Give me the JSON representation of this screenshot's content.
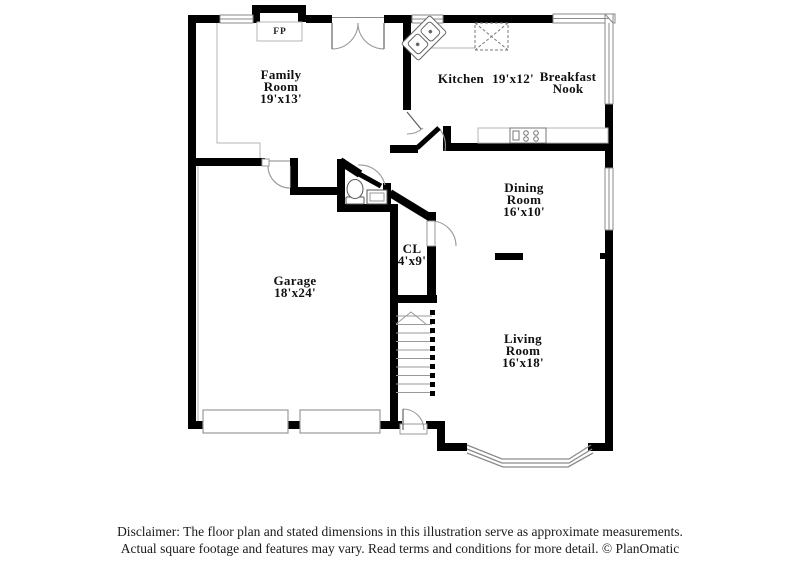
{
  "floorplan": {
    "labels": {
      "family": {
        "l1": "Family",
        "l2": "Room",
        "l3": "19'x13'"
      },
      "kitchen": {
        "name": "Kitchen",
        "dims": "19'x12'"
      },
      "breakfast": {
        "l1": "Breakfast",
        "l2": "Nook"
      },
      "dining": {
        "l1": "Dining",
        "l2": "Room",
        "l3": "16'x10'"
      },
      "closet": {
        "l1": "CL",
        "l2": "4'x9'"
      },
      "garage": {
        "l1": "Garage",
        "l2": "18'x24'"
      },
      "living": {
        "l1": "Living",
        "l2": "Room",
        "l3": "16'x18'"
      },
      "fireplace": "FP"
    },
    "rooms_summary": [
      {
        "room": "Family Room",
        "dimensions": "19'x13'"
      },
      {
        "room": "Kitchen",
        "dimensions": "19'x12'"
      },
      {
        "room": "Breakfast Nook",
        "dimensions": ""
      },
      {
        "room": "Dining Room",
        "dimensions": "16'x10'"
      },
      {
        "room": "Closet (CL)",
        "dimensions": "4'x9'"
      },
      {
        "room": "Garage",
        "dimensions": "18'x24'"
      },
      {
        "room": "Living Room",
        "dimensions": "16'x18'"
      }
    ]
  },
  "footer": {
    "line1": "Disclaimer: The floor plan and stated dimensions in this illustration serve as approximate measurements.",
    "line2": "Actual square footage and features may vary. Read terms and conditions for more detail. © PlanOmatic"
  },
  "colors": {
    "wall": "#000000",
    "window_border": "#8a8a8a",
    "interior_line": "#b5b5b5",
    "fixture_line": "#555555",
    "text": "#1a1a1a",
    "background": "#ffffff"
  }
}
